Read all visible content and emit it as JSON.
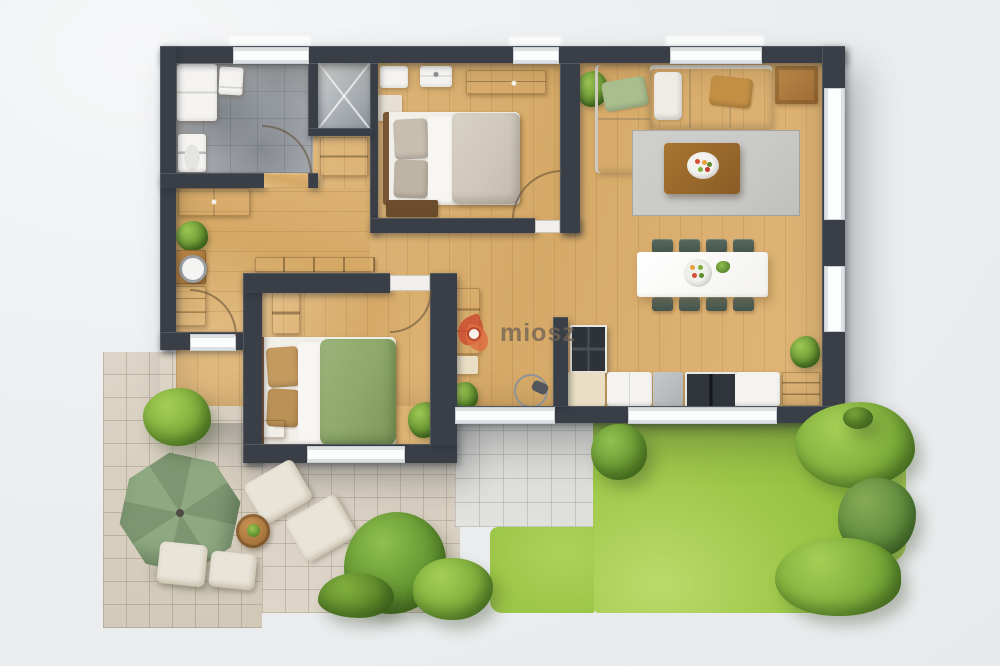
{
  "watermark": {
    "brand": "miosz"
  },
  "palette": {
    "wall": "#3a3f47",
    "wood": "#ddb176",
    "bathfloor": "#a6aaaf",
    "cream": "#e9e5de",
    "duvetbeige": "#cfc7ba",
    "duvetgreen": "#8ea96b",
    "pillowtan": "#c49a5f",
    "rug": "#c9c9c7",
    "chair": "#4e5f58",
    "grass": "#9cc647",
    "grasslight": "#bada6a",
    "bush": "#7fae3c",
    "bushlight": "#a4cf55",
    "bushdark": "#5f8e2d",
    "patio": "#d8cfc0",
    "terrace": "#dbdbd7",
    "umbrella": "#8ea982",
    "umbrelladark": "#7d9671",
    "logored": "#cc4a30",
    "logotext": "#6f6355"
  },
  "scene": {
    "type": "floor-plan",
    "rooms": [
      {
        "name": "bathroom"
      },
      {
        "name": "shower"
      },
      {
        "name": "wardrobe-nook"
      },
      {
        "name": "main-bedroom"
      },
      {
        "name": "hallway"
      },
      {
        "name": "second-bedroom"
      },
      {
        "name": "living-room"
      },
      {
        "name": "dining-area"
      },
      {
        "name": "kitchen"
      }
    ],
    "exterior": [
      "patio",
      "terrace",
      "lawn",
      "garden-bushes"
    ],
    "furniture_counts": {
      "dining_chairs": 8,
      "beds": 2,
      "sun_loungers": 2,
      "parasol": 1
    }
  }
}
